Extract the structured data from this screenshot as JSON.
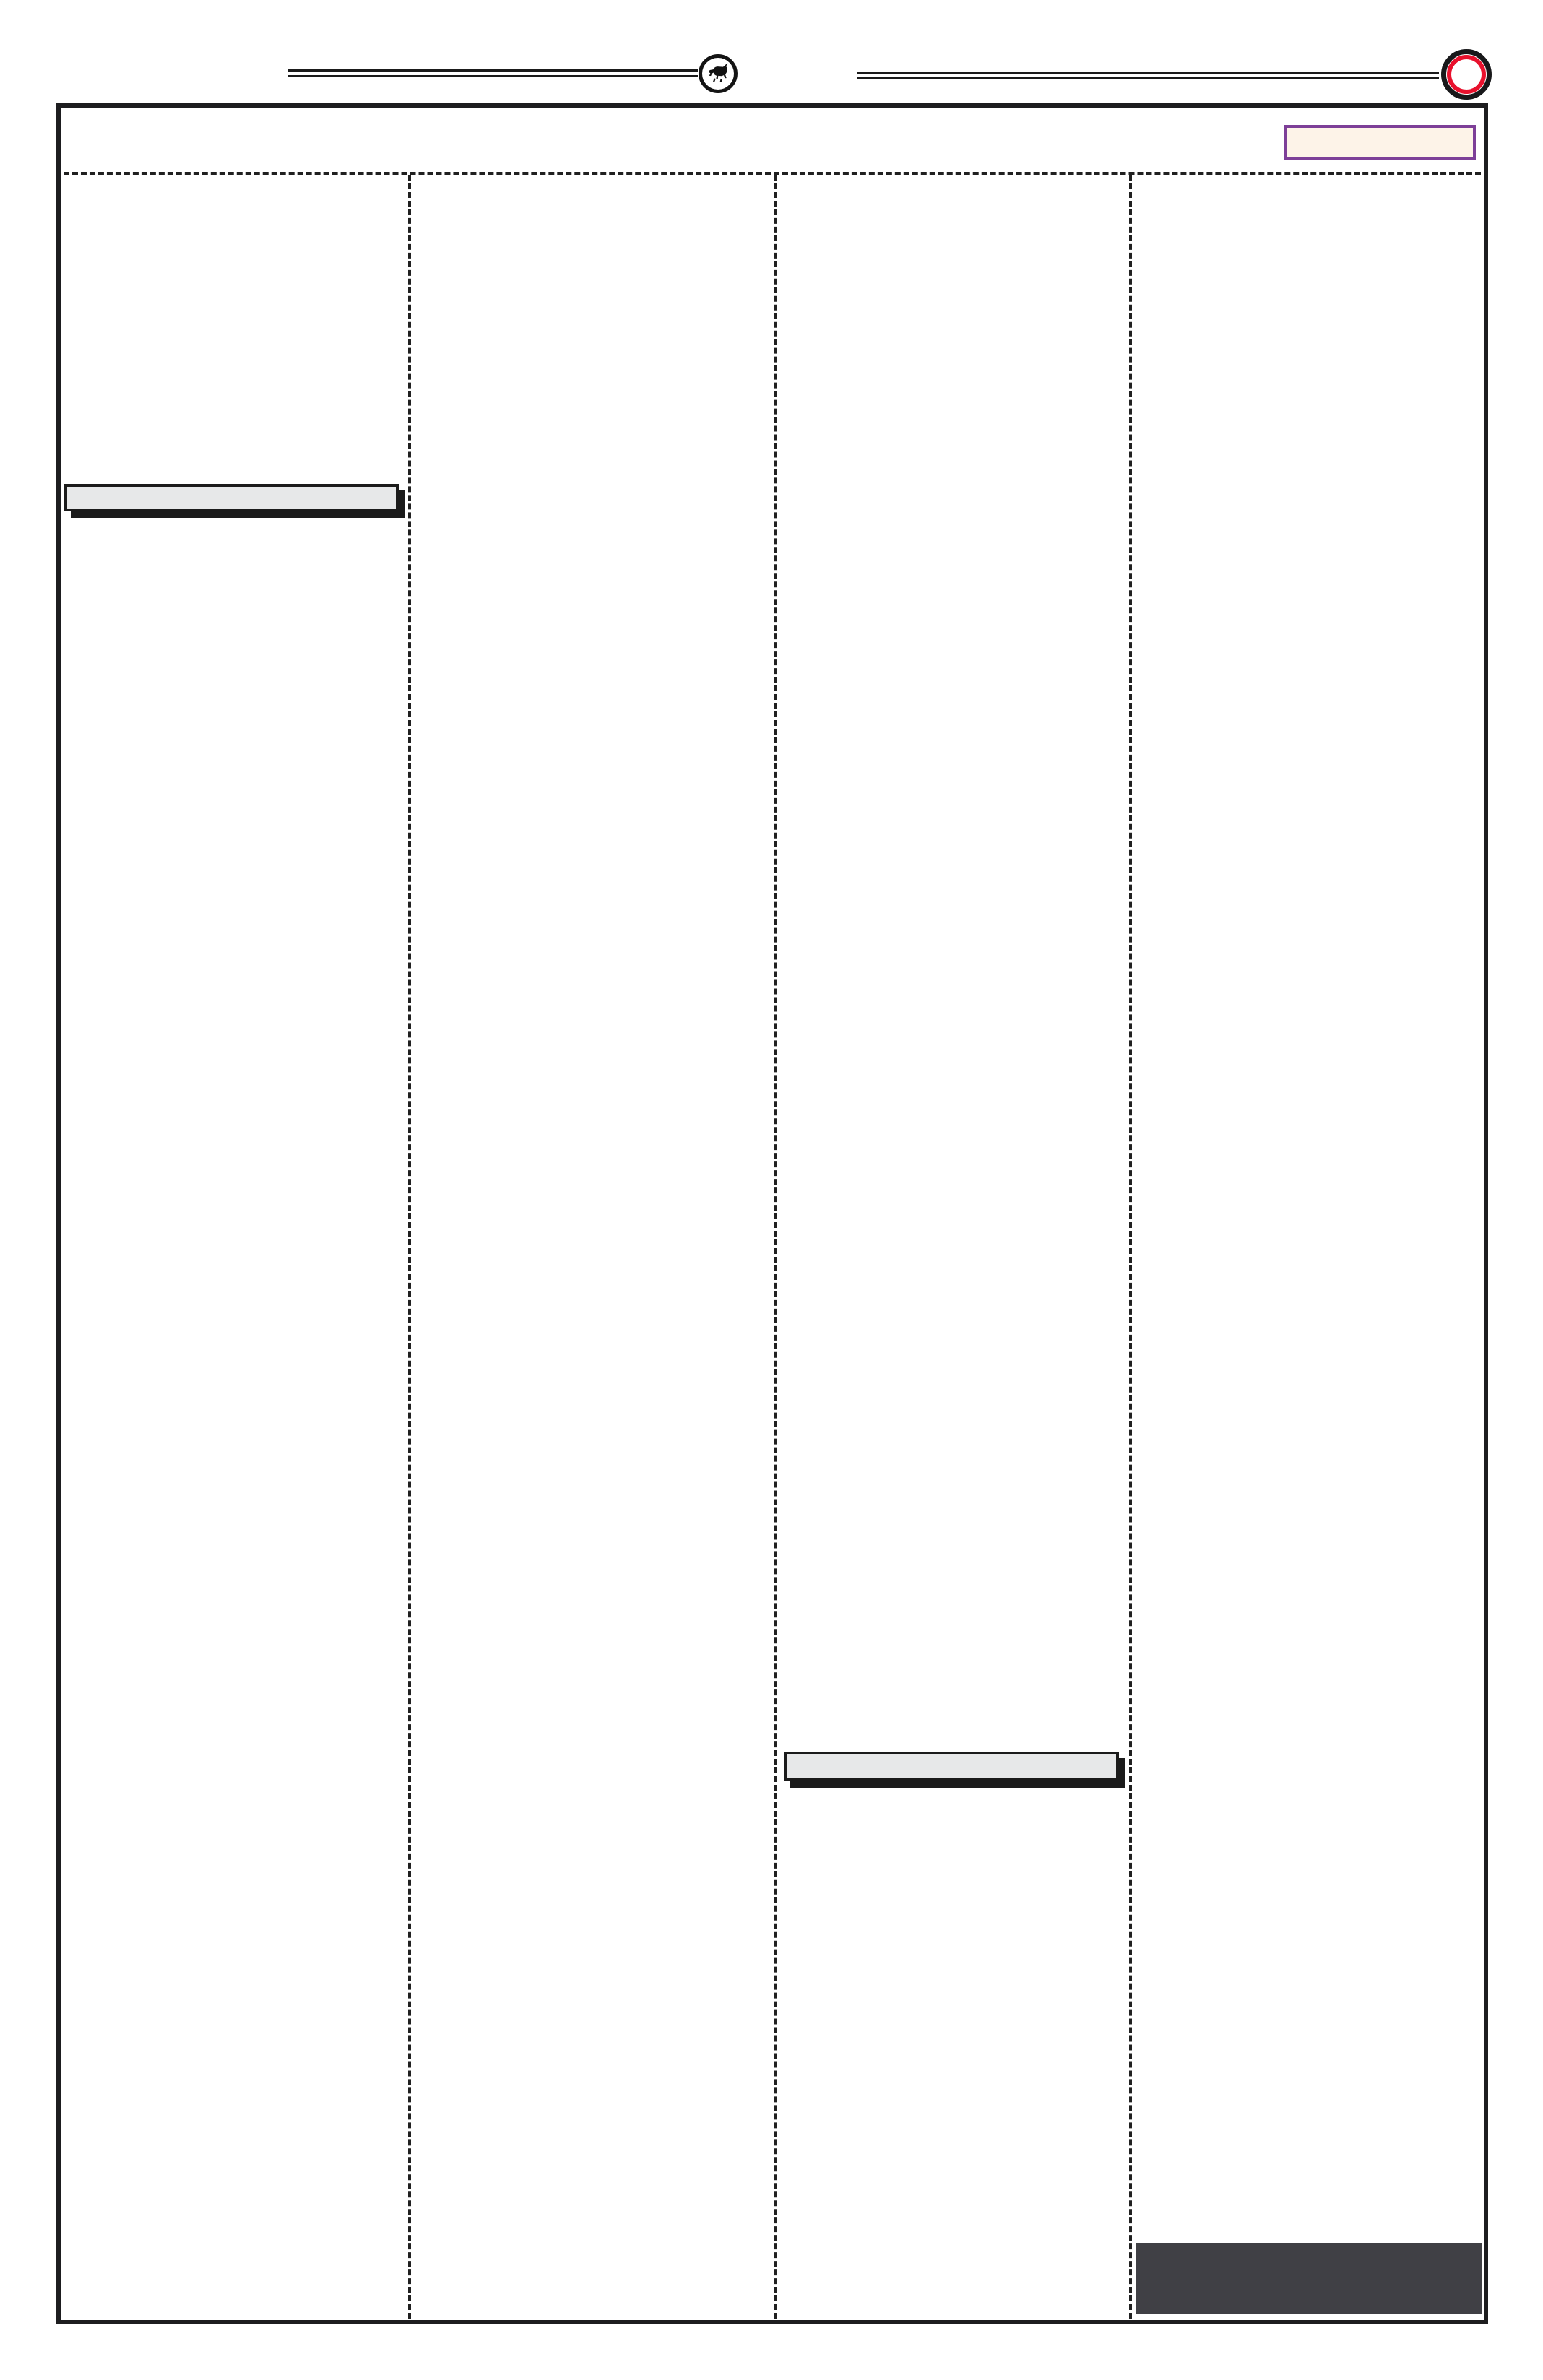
{
  "page": {
    "background_color": "#ffffff",
    "frame_border_color": "#1d1d1f",
    "divider_color": "#202020",
    "columns": 4
  },
  "masthead": {
    "left_rule": {
      "style": "double",
      "color": "#1b1b1b"
    },
    "right_rule": {
      "style": "double",
      "color": "#1b1b1b"
    },
    "logo_badge": {
      "icon": "bull-logo-icon",
      "ring_color": "#141414",
      "glyph_color": "#111111"
    },
    "seal": {
      "icon": "red-seal-icon",
      "outer_ring_color": "#18181a",
      "inner_ring_color": "#e8112d",
      "center_color": "#ffffff"
    }
  },
  "ear_box": {
    "fill_color": "#fdf3e8",
    "border_color": "#7d3f98",
    "text": ""
  },
  "placeholders": {
    "headline_bar_col1": {
      "fill_color": "#e7e8e9",
      "border_color": "#1b1b1b",
      "shadow_color": "#1b1b1b",
      "text": ""
    },
    "headline_bar_col3": {
      "fill_color": "#e7e8e9",
      "border_color": "#1b1b1b",
      "shadow_color": "#1b1b1b",
      "text": ""
    },
    "footer_block_col4": {
      "fill_color": "#404045",
      "text": ""
    }
  }
}
